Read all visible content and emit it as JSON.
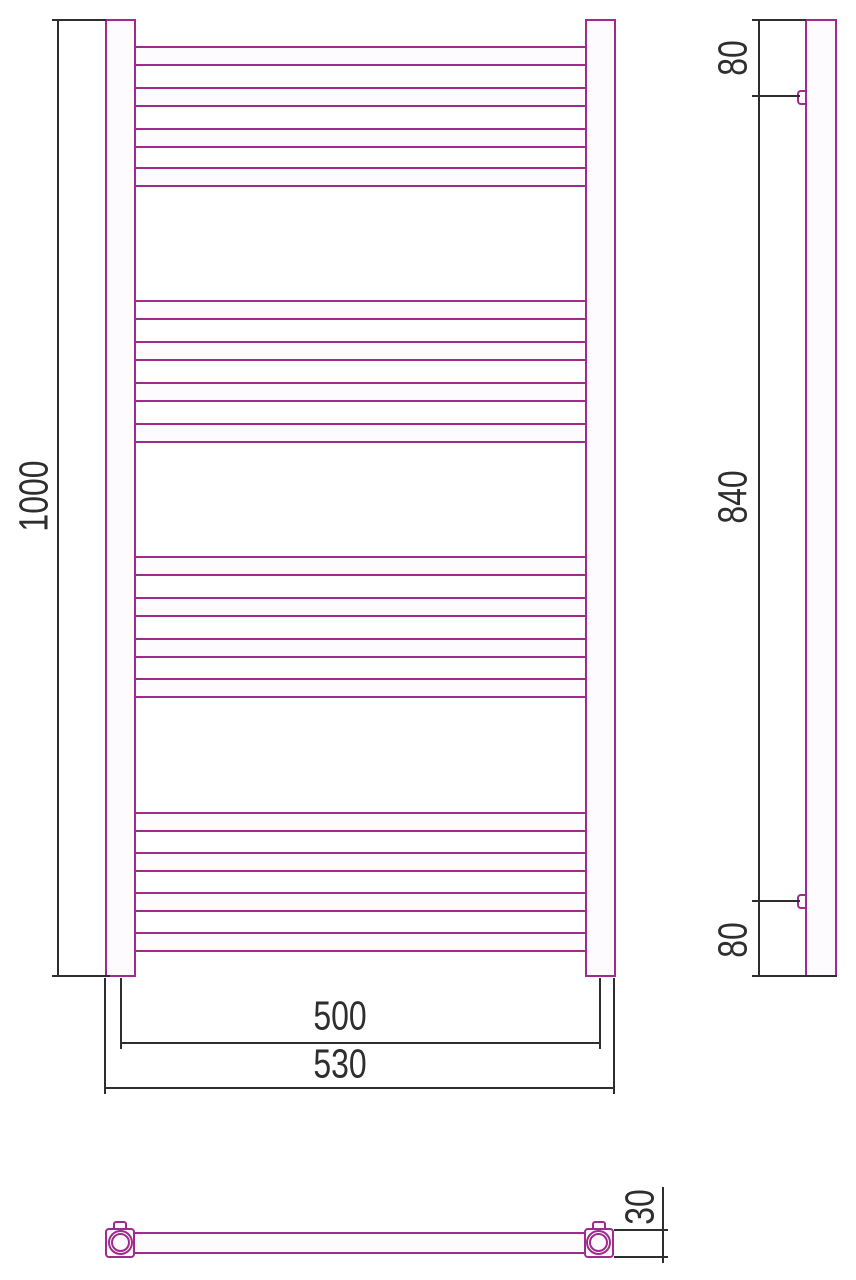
{
  "drawing_title": "heated-towel-rail-dimension-drawing",
  "colors": {
    "product_outline": "#9F2B8C",
    "dimension_lines": "#2E2E2E",
    "background": "#FFFFFF",
    "product_fill": "#FEFBFE"
  },
  "dimensions": {
    "front_height": "1000",
    "front_connection_spacing": "500",
    "front_overall_width": "530",
    "side_top_offset": "80",
    "side_bracket_spacing": "840",
    "side_bottom_offset": "80",
    "bottom_depth": "30"
  },
  "front_view": {
    "rung_group_tops": [
      [
        46,
        87,
        128,
        167
      ],
      [
        300,
        341,
        382,
        423
      ],
      [
        556,
        597,
        638,
        678
      ],
      [
        812,
        852,
        892,
        932
      ]
    ],
    "rung_count": 16,
    "group_count": 4
  },
  "side_view": {
    "bracket_positions_y": [
      90,
      894
    ]
  },
  "bottom_view": {
    "fitting_count": 2
  }
}
